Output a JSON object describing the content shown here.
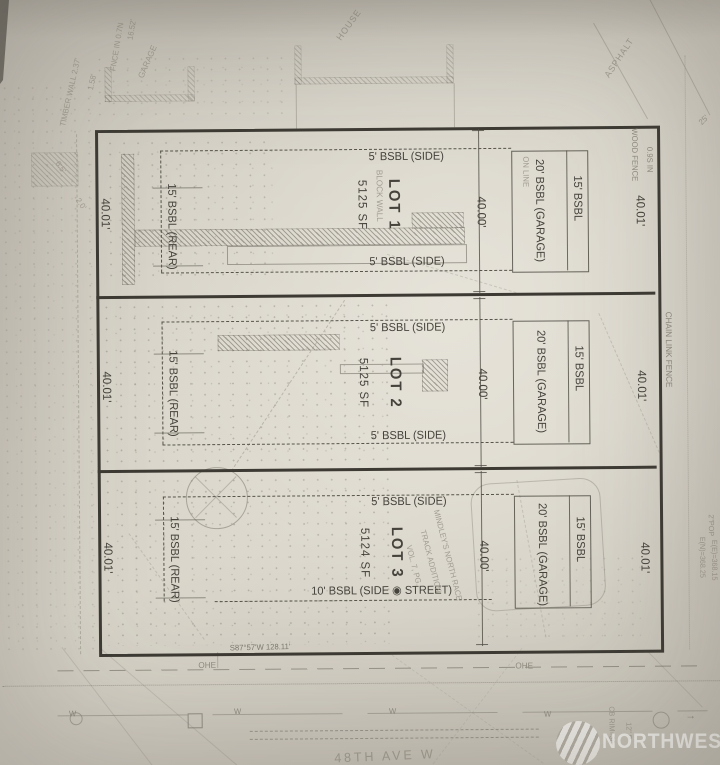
{
  "lots": [
    {
      "name": "LOT 1",
      "area": "5125 SF",
      "front": "40.00'",
      "left": "40.01'",
      "right": "40.01'",
      "top_sb": "5' BSBL (SIDE)",
      "bottom_sb": "5' BSBL (SIDE)",
      "rear_sb": "15' BSBL (REAR)",
      "garage_sb": "20' BSBL (GARAGE)",
      "side_sb": "15' BSBL"
    },
    {
      "name": "LOT 2",
      "area": "5125 SF",
      "front": "40.00'",
      "left": "40.01'",
      "right": "40.01'",
      "top_sb": "5' BSBL (SIDE)",
      "bottom_sb": "5' BSBL (SIDE)",
      "rear_sb": "15' BSBL (REAR)",
      "garage_sb": "20' BSBL (GARAGE)",
      "side_sb": "15' BSBL"
    },
    {
      "name": "LOT 3",
      "area": "5124 SF",
      "front": "40.00'",
      "left": "40.01'",
      "right": "40.01'",
      "top_sb": "5' BSBL (SIDE)",
      "bottom_sb": "10' BSBL (SIDE ◉ STREET)",
      "rear_sb": "15' BSBL (REAR)",
      "garage_sb": "20' BSBL (GARAGE)",
      "side_sb": "15' BSBL"
    }
  ],
  "survey": {
    "south_bearing": "S87°57'W  128.11'",
    "street": "48TH AVE W",
    "ohe": "OHE",
    "water": "W"
  },
  "ann": {
    "house": "HOUSE",
    "garage": "GARAGE",
    "asphalt": "ASPHALT",
    "timber_wall": "TIMBER WALL 2.37'",
    "fence_in": "FNCE IN 0.7N",
    "dim_1652": "16.52'",
    "dim_158": "1.58'",
    "dim_65": "6.5'",
    "dim_20": "2.0'",
    "dim_25": "25'",
    "wood_fence": "WOOD FENCE",
    "wood_fence_off": "0.9S IN",
    "block_wall": "BLOCK WALL",
    "on_line": "ON LINE",
    "chain_link": "CHAIN LINK FENCE",
    "plat1": "MINDLEY'S NORTH RACE",
    "plat2": "TRACK ADDITION",
    "plat3": "VOL. 7, PG.",
    "cb": "CB RIM=36",
    "pipe": "12\" P",
    "elev_n": "E(N)=368.25",
    "elev_e": "E(E)=368.15",
    "pop": "2\"POP"
  },
  "watermark": {
    "brand": "NORTHWEST"
  }
}
